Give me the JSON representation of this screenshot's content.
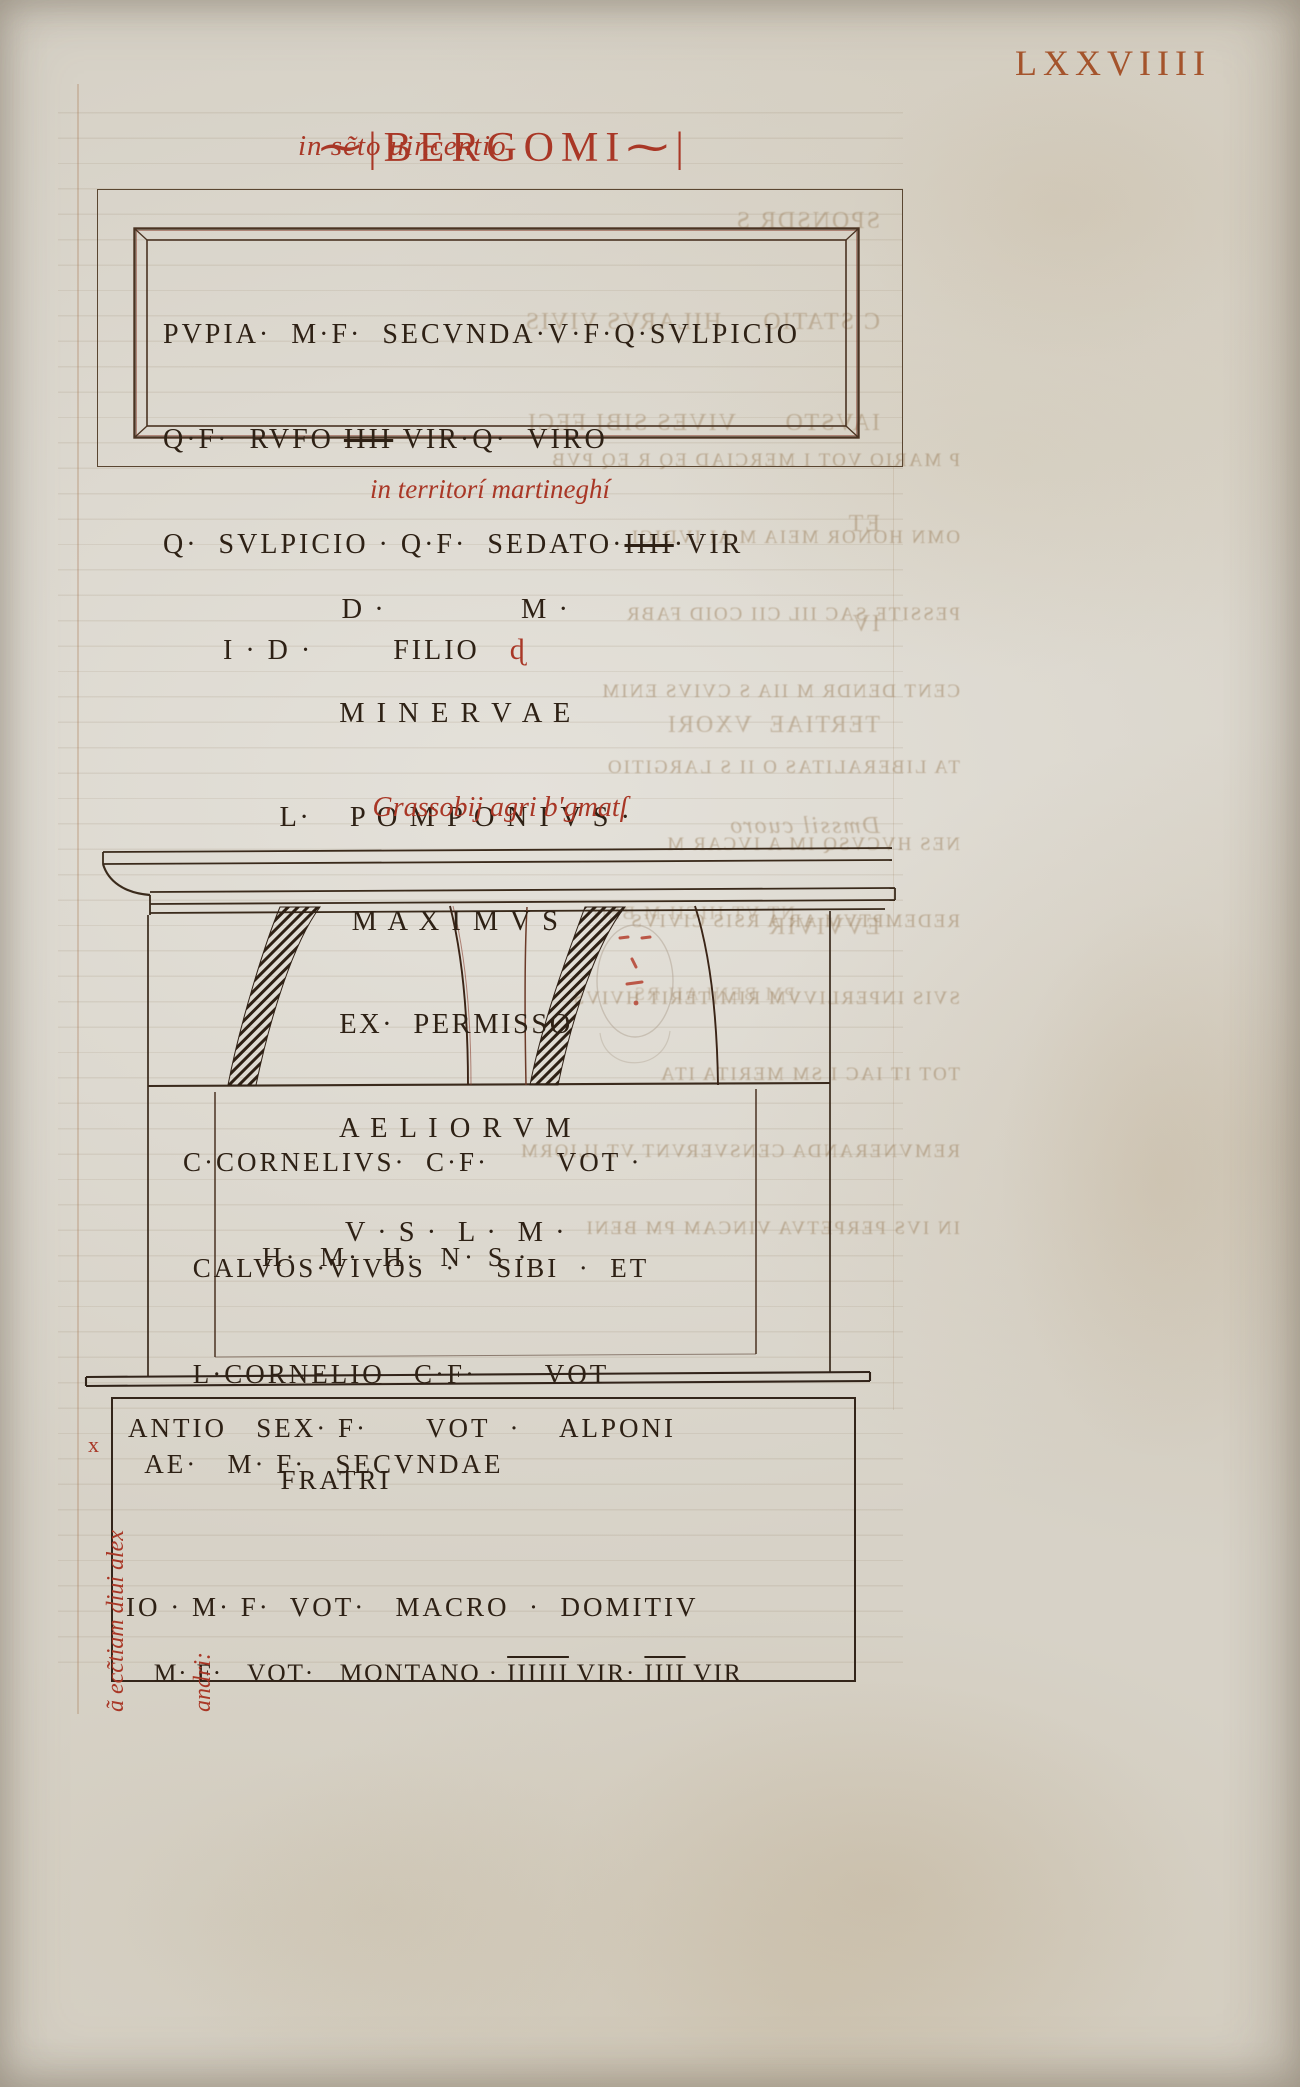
{
  "folio_number": "LXXVIIII",
  "header": {
    "title_pre": "⁓|",
    "title": "BERGOMI",
    "title_post": "⁓|",
    "subtitle": "in sc̃to uincentio"
  },
  "inscription1": {
    "line1": "PVPIA·  M·F·  SECVNDA·V·F·Q·SVLPICIO",
    "line2_pre": "Q·F·  RVFO ",
    "line2_strike": "IIII",
    "line2_post": " VIR·Q·  VIRO",
    "line3_pre": "Q·  SVLPICIO · Q·F·  SEDATO·",
    "line3_strike": "IIII",
    "line3_post": "·VIR",
    "line4": "      I · D ·        FILIO   ",
    "line4_mark": "ɖ"
  },
  "caption_territori": "in territorí martineghí",
  "inscription2": {
    "line1": "D ·              M ·",
    "line2": "M I N E R V A E",
    "line3": "L·    P O M P O N I V S ·",
    "line4": "M A X I M V S",
    "line5": "EX·  PERMISSO",
    "line6": "A E L I O R V M",
    "line7": "V · S ·  L ·  M ·"
  },
  "caption_grassobii": "Grassobij agri b'gmatſ",
  "monument_inscription": {
    "line1": "C·CORNELIVS·  C·F·       VOT ·",
    "line2": " CALVOS·VIVOS  ·    SIBI  ·  ET",
    "line3": " L·CORNELIO   C·F·       VOT",
    "line4": "          FRATRI",
    "line5": "H·  M·  H·  N· S ·"
  },
  "inscription4": {
    "margin_mark": "x",
    "line1": "ANTIO   SEX· F·      VOT  ·    ALPONI",
    "line2": " AE·   M· F·   SECVNDAE",
    "line3": "IO · M· F·  VOT·   MACRO  ·  DOMITIV",
    "line4_pre": "M· F·   VOT·   MONTANO · ",
    "line4_num1": "IIIIII",
    "line4_mid": " VIR· ",
    "line4_num2": "IIII",
    "line4_end": " VIR"
  },
  "margin_note": {
    "line1": "ã ecc̃tiam diui alex",
    "line2": "andri:"
  },
  "bleed": {
    "a": [
      "SPONSDR S",
      "C STATIO     HILARVS VIVIS",
      "IAVSTO      VIVES SIBI FECI",
      "ET",
      "IV",
      "TERTIAE  VXORI",
      "Dmssil cuoro",
      "EVVIVIR"
    ],
    "b": [
      "P MARIO VOT I MERCIAD EQ R EQ PVB",
      "OMN HONOR MEIA M AI IVDICI",
      "PESSITE SAC IIL CII COID FABR",
      "CENT DENDR M IIA S CVIVS ENIM",
      "TA LIBERALITAS O II S LARGITIO",
      "NES HVCVSQ IM A IVCAR M",
      "REDEMPTVM AR A RSIS CIVIVS",
      "SVIS INPERLIVVM RIMITERIT HVIVS",
      "TOT IT IAC I SM MERITA ITA",
      "REMVNERANDA CENSVERVNT VT ILIORM",
      "IN IVS PERPETVA VINCAM PM BENI"
    ],
    "c": [
      "NT VT IIICII M BEN",
      "PM BENI AII RS"
    ]
  },
  "colors": {
    "red_ink": "#a93726",
    "folio_ink": "#a5542c",
    "black_ink": "#2e2115",
    "frame_line": "#5a4631",
    "parchment": "#d9d4c9"
  }
}
